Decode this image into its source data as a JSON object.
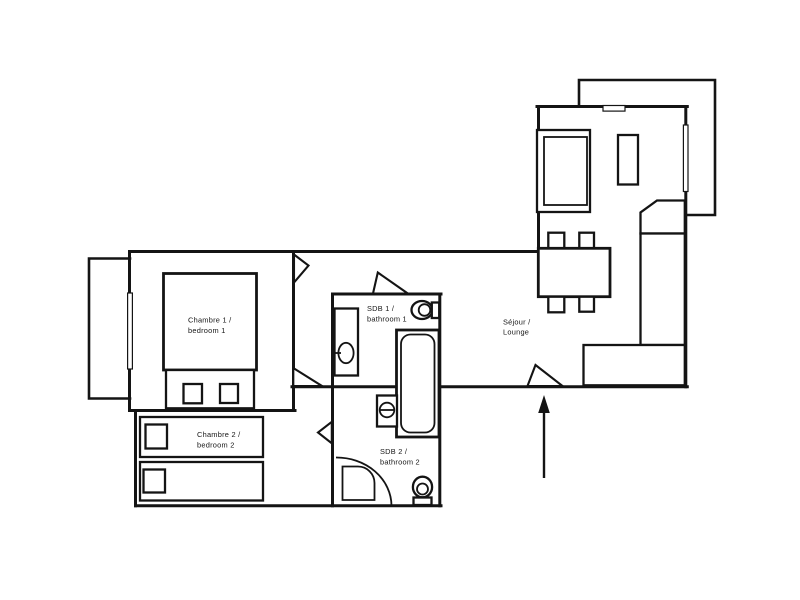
{
  "colors": {
    "line": "#141414",
    "background": "#ffffff"
  },
  "rooms": {
    "bedroom1": {
      "line1": "Chambre 1 /",
      "line2": "bedroom 1"
    },
    "bedroom2": {
      "line1": "Chambre 2 /",
      "line2": "bedroom 2"
    },
    "bathroom1": {
      "line1": "SDB 1 /",
      "line2": "bathroom 1"
    },
    "bathroom2": {
      "line1": "SDB 2 /",
      "line2": "bathroom 2"
    },
    "lounge": {
      "line1": "Séjour /",
      "line2": "Lounge"
    }
  }
}
